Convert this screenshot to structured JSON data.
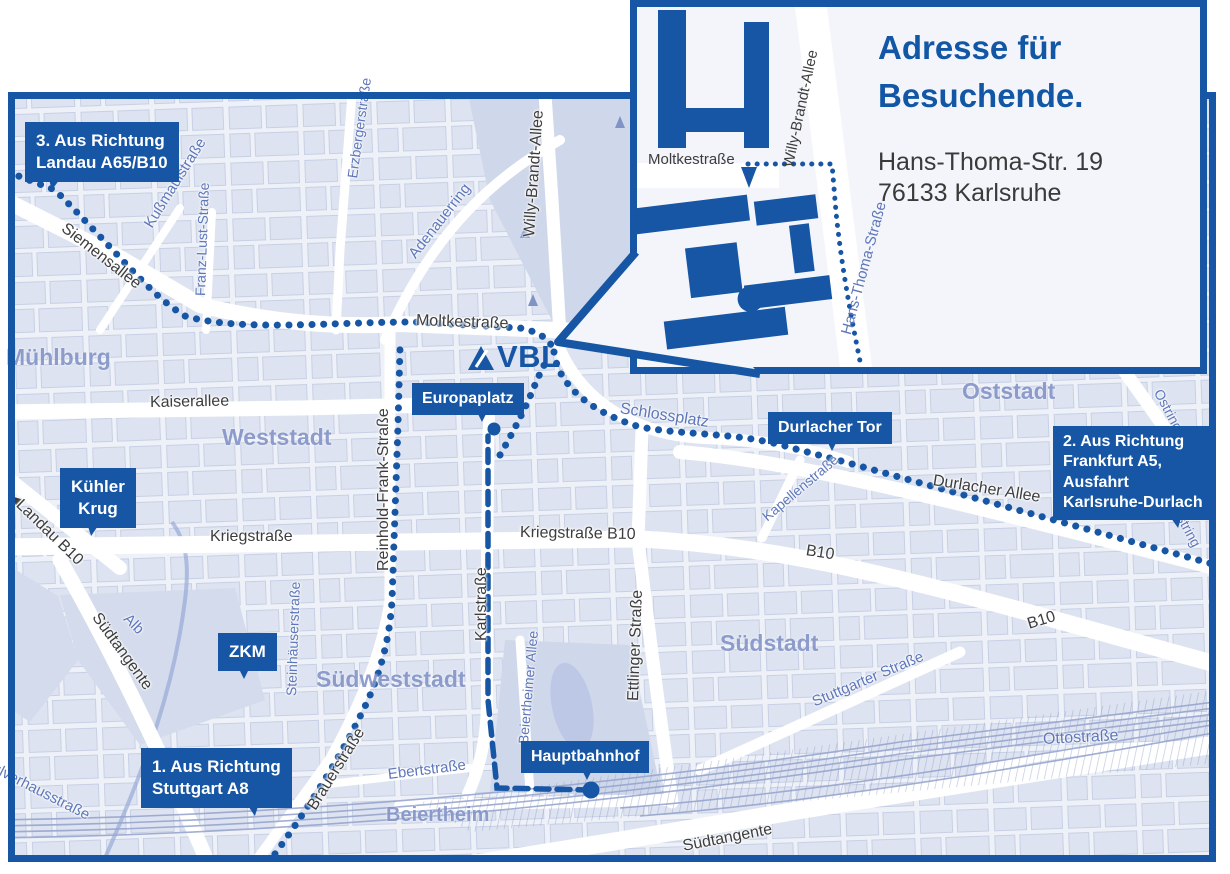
{
  "colors": {
    "primary_blue": "#1656a4",
    "title_blue": "#1257a5",
    "map_background": "#eef1f7",
    "city_block": "#dde3f0",
    "park": "#cfd7ea",
    "street_label_dark": "#3d3d3d",
    "street_label_blue": "#5e77ba",
    "area_label_blue": "#8494c8",
    "railway": "#98a6ce"
  },
  "logo": {
    "name": "VBL"
  },
  "icons": {
    "landau_arrow": "◀",
    "route_dot": "●",
    "entrance_arrow": "▼"
  },
  "inset": {
    "title": [
      "Adresse für",
      "Besuchende."
    ],
    "address": [
      "Hans-Thoma-Str. 19",
      "76133 Karlsruhe"
    ],
    "streets": {
      "moltke": "Moltkestraße",
      "willy": "Willy-Brandt-Allee",
      "hansthoma": "Hans-Thoma-Straße"
    }
  },
  "callouts": {
    "landau": {
      "lines": [
        "3. Aus Richtung",
        "Landau A65/B10"
      ]
    },
    "kuehler_krug": {
      "lines": [
        "Kühler",
        "Krug"
      ]
    },
    "zkm": {
      "lines": [
        "ZKM"
      ]
    },
    "stuttgart": {
      "lines": [
        "1. Aus Richtung",
        "Stuttgart A8"
      ]
    },
    "europaplatz": {
      "lines": [
        "Europaplatz"
      ]
    },
    "durlacher_tor": {
      "lines": [
        "Durlacher Tor"
      ]
    },
    "frankfurt": {
      "lines": [
        "2. Aus Richtung",
        "Frankfurt A5,",
        "Ausfahrt",
        "Karlsruhe-Durlach"
      ]
    },
    "hauptbahnhof": {
      "lines": [
        "Hauptbahnhof"
      ]
    }
  },
  "areas": {
    "muehlburg": "Mühlburg",
    "weststadt": "Weststadt",
    "oststadt": "Oststadt",
    "suedstadt": "Südstadt",
    "suedweststadt": "Südweststadt",
    "beiertheim": "Beiertheim"
  },
  "streets": {
    "siemensallee": "Siemensallee",
    "kussmaulstrasse": "Kußmaulstraße",
    "franz_lust": "Franz-Lust-Straße",
    "erzbergerstrasse": "Erzbergerstraße",
    "adenauerring": "Adenauerring",
    "willy_brandt": "Willy-Brandt-Allee",
    "moltkestrasse": "Moltkestraße",
    "kaiserallee": "Kaiserallee",
    "reinhold_frank": "Reinhold-Frank-Straße",
    "kriegstrasse": "Kriegstraße",
    "kriegstrasse_b10": "Kriegstraße B10",
    "karlstrasse": "Karlstraße",
    "ettlinger": "Ettlinger Straße",
    "schlossplatz": "Schlossplatz",
    "kapellenstrasse": "Kapellenstraße",
    "durlacher_allee": "Durlacher Allee",
    "b10": "B10",
    "ostring": "Ostring",
    "stuttgarter": "Stuttgarter Straße",
    "suedtangente": "Südtangente",
    "steinhaeuser": "Steinhäuserstraße",
    "brauerstrasse": "Brauerstraße",
    "ebertstrasse": "Ebertstraße",
    "alb": "Alb",
    "pulverhaus": "Pulverhausstraße",
    "ottostrasse": "Ottostraße",
    "landau_b10": "Landau B10",
    "beiertheimer_allee": "Beiertheimer Allee"
  }
}
